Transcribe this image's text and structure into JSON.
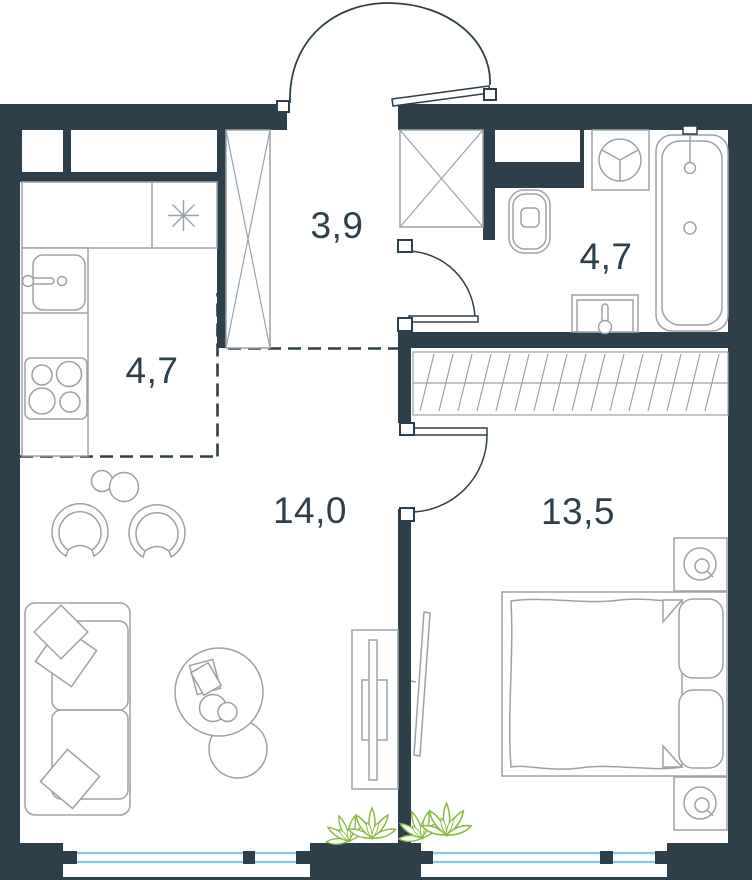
{
  "plan": {
    "type": "apartment-floor-plan",
    "rooms": [
      {
        "id": "hallway",
        "area_m2": "3,9"
      },
      {
        "id": "kitchen",
        "area_m2": "4,7"
      },
      {
        "id": "bathroom",
        "area_m2": "4,7"
      },
      {
        "id": "living_room",
        "area_m2": "14,0"
      },
      {
        "id": "bedroom",
        "area_m2": "13,5"
      }
    ],
    "colors": {
      "wall": "#2c3f4a",
      "line": "#9aa2a7",
      "glass": "#82c7e4",
      "plant": "#8aba3e",
      "floor": "#ffffff"
    },
    "fixtures": {
      "kitchen": [
        "upper-cabinet-small",
        "upper-cabinet-wide",
        "counter",
        "fridge-snowflake",
        "sink",
        "stove-4-burner"
      ],
      "hallway": [
        "wardrobe-cross",
        "entrance-door"
      ],
      "bathroom": [
        "vent-shaft-cross",
        "washing-machine",
        "toilet",
        "bathtub",
        "sink",
        "door"
      ],
      "bedroom": [
        "built-in-wardrobe-hatch",
        "double-bed",
        "pillows",
        "nightstand-with-lamp-top",
        "nightstand-with-lamp-bottom",
        "wall-tv",
        "plant",
        "window",
        "door"
      ],
      "living_room": [
        "sofa-with-pillows",
        "armchair-left",
        "armchair-right",
        "side-table",
        "coffee-table",
        "pouf",
        "book",
        "cups",
        "tv-stand",
        "plant",
        "window"
      ]
    }
  }
}
